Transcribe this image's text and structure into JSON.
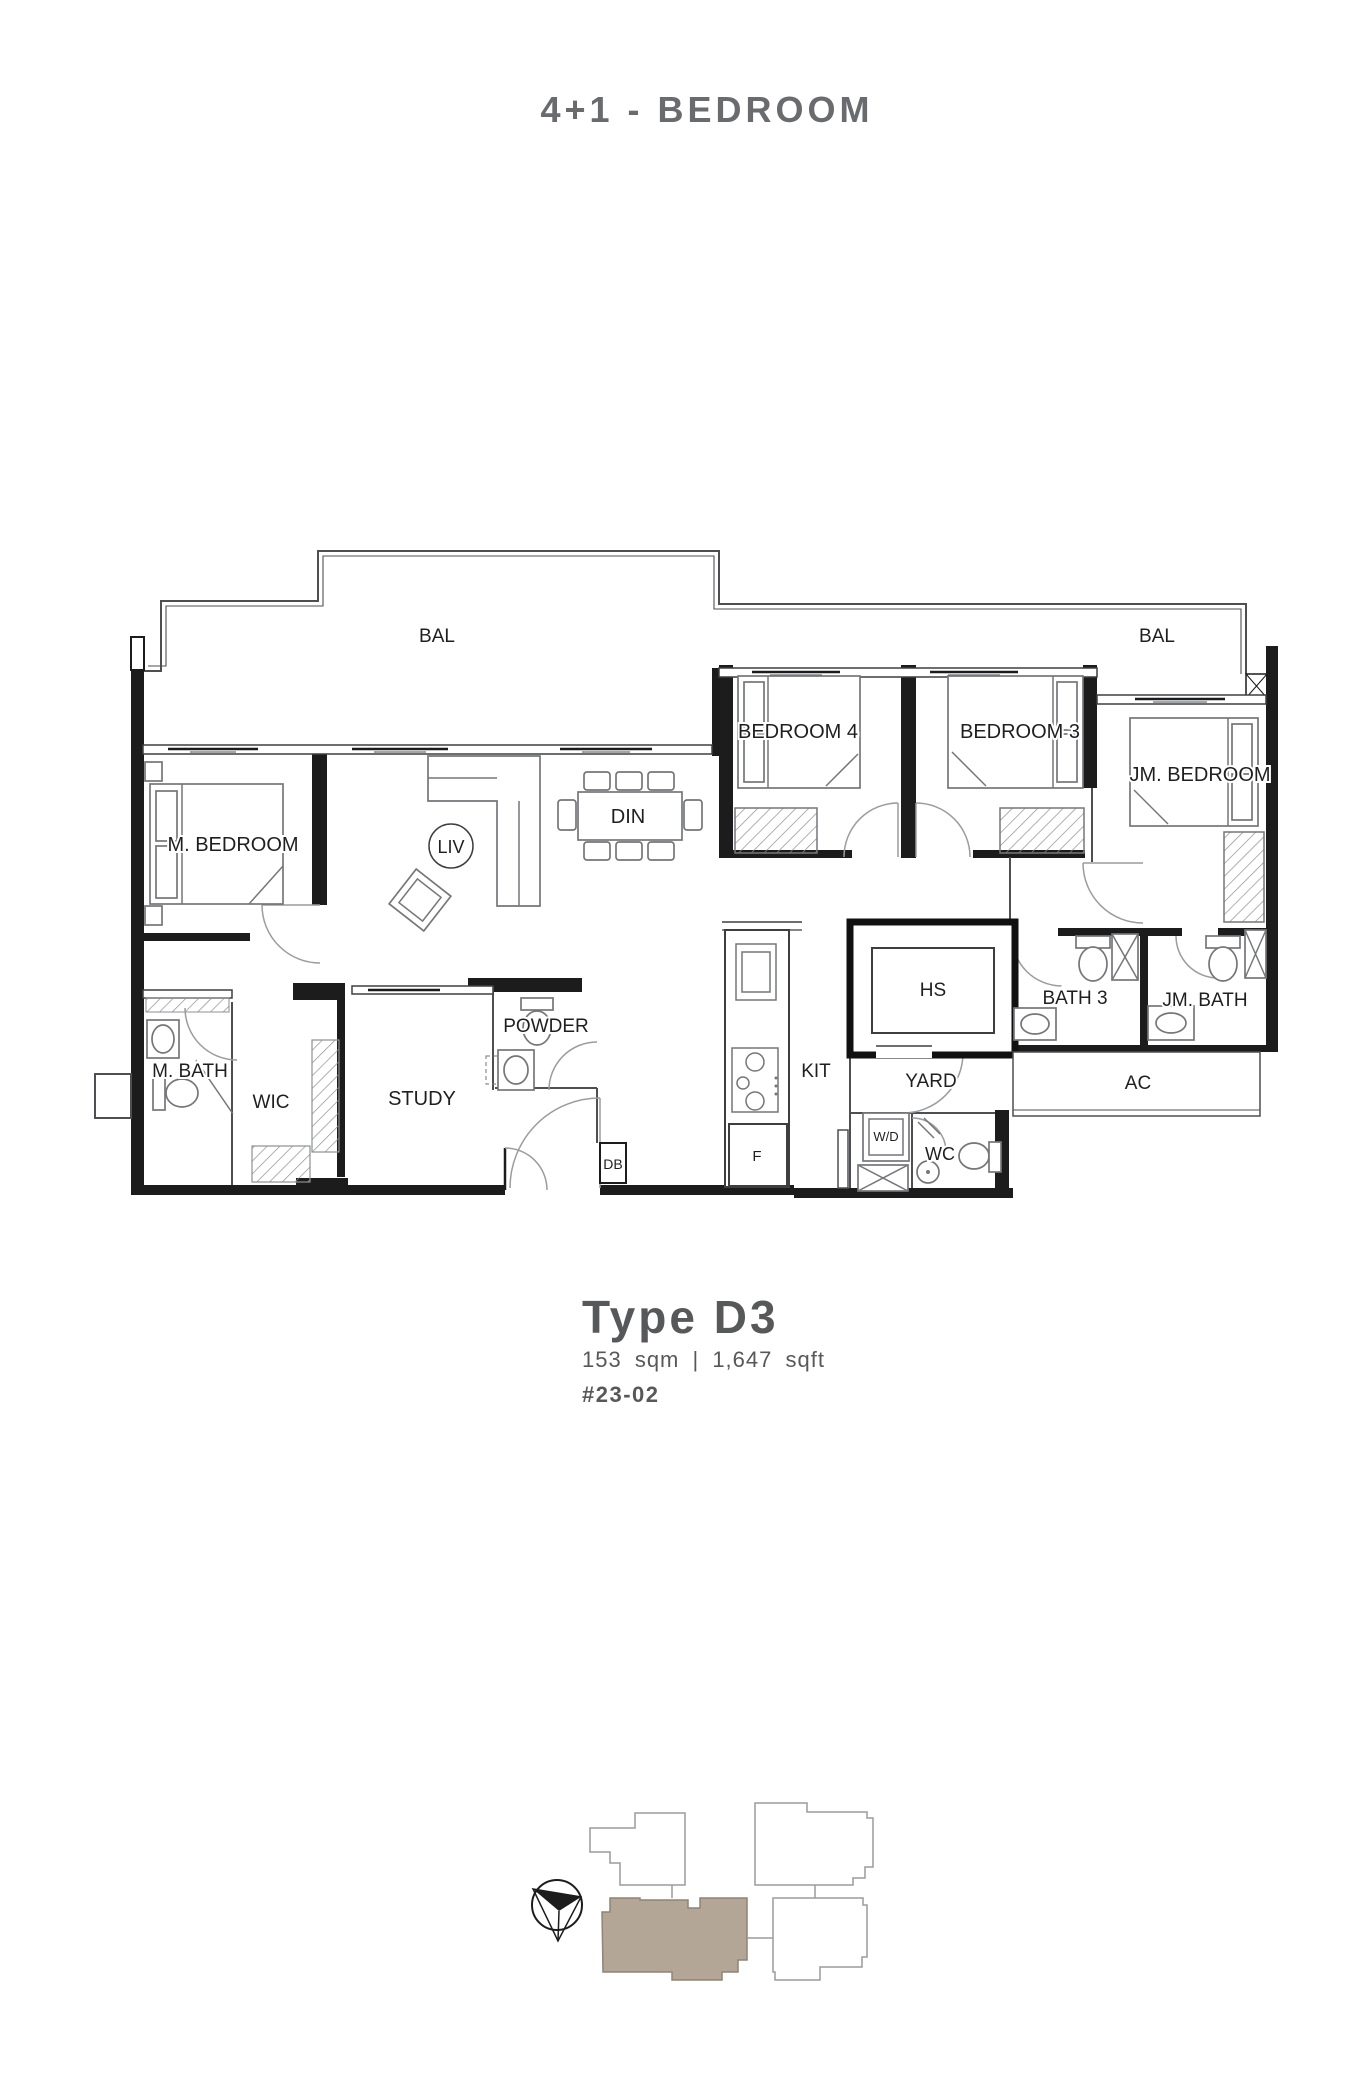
{
  "header": {
    "title": "4+1 - BEDROOM"
  },
  "plan": {
    "rooms": {
      "bal_left": "BAL",
      "bal_right": "BAL",
      "m_bedroom": "M. BEDROOM",
      "liv": "LIV",
      "din": "DIN",
      "bedroom4": "BEDROOM 4",
      "bedroom3": "BEDROOM 3",
      "jm_bedroom": "JM. BEDROOM",
      "m_bath": "M. BATH",
      "wic": "WIC",
      "study": "STUDY",
      "powder": "POWDER",
      "db": "DB",
      "kit": "KIT",
      "fridge": "F",
      "hs": "HS",
      "yard": "YARD",
      "wd": "W/D",
      "wc": "WC",
      "bath3": "BATH 3",
      "jm_bath": "JM. BATH",
      "ac": "AC"
    }
  },
  "details": {
    "type_name": "Type D3",
    "area": "153 sqm | 1,647 sqft",
    "unit_number": "#23-02"
  },
  "colors": {
    "title_text": "#6a6b6e",
    "details_text": "#57585a",
    "highlight_fill": "#b3a697"
  }
}
